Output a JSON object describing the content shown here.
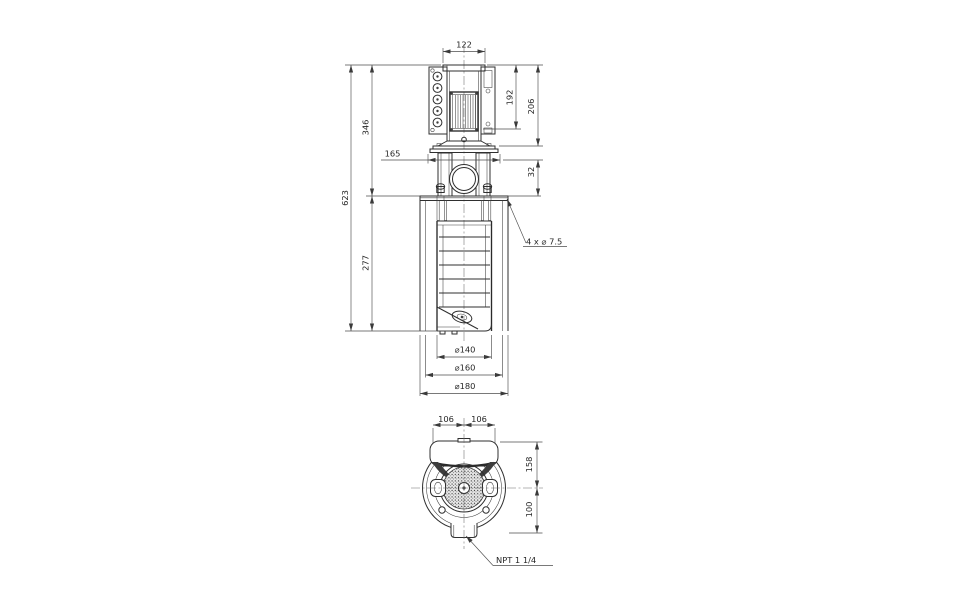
{
  "colors": {
    "background": "#ffffff",
    "object_line": "#2f2f2f",
    "dimension_line": "#4d4d4d"
  },
  "front_view": {
    "dims": {
      "motor_width": "122",
      "motor_core_height": "192",
      "motor_total_height": "206",
      "top_to_mount_flange": "346",
      "total_length": "623",
      "coupling_flange_width": "165",
      "flange_offset": "32",
      "sleeve_section": "277",
      "dia_chambers": "⌀140",
      "dia_sleeve": "⌀160",
      "dia_mount_flange": "⌀180",
      "mount_holes": "4  x ⌀ 7.5"
    }
  },
  "top_view": {
    "dims": {
      "half_width_left": "106",
      "half_width_right": "106",
      "center_to_box": "158",
      "center_to_outlet": "100"
    },
    "connection_label": "NPT 1 1/4"
  }
}
